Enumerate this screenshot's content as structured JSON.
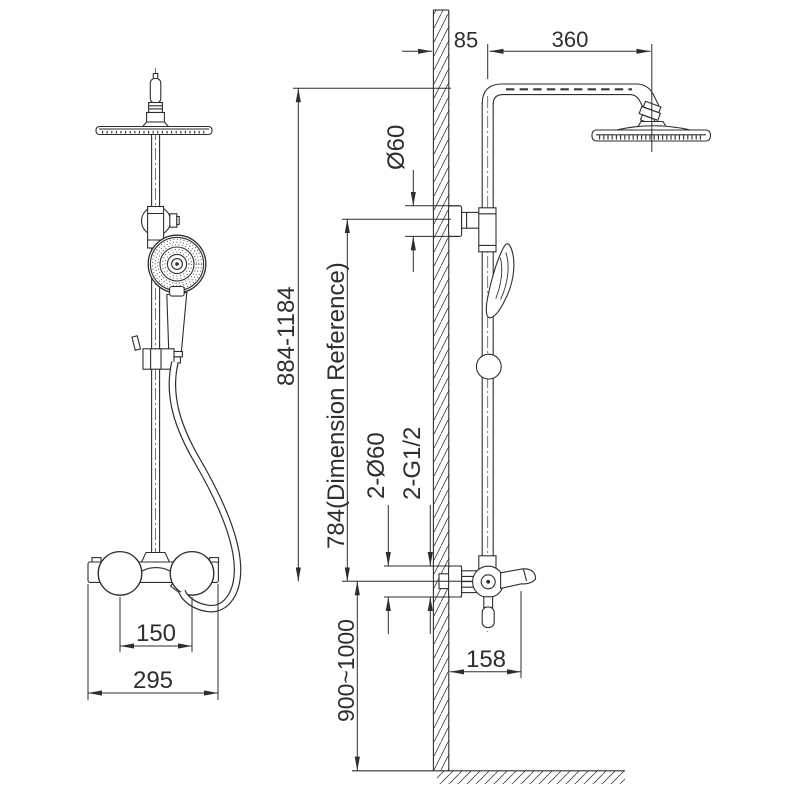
{
  "meta": {
    "background": "#ffffff",
    "ink": "#2e2e2e",
    "drawing_type": "technical dimension drawing",
    "subject": "thermostatic shower column system — front view and wall-mounted side view"
  },
  "dimensions": {
    "wall_offset": "85",
    "arm_reach": "360",
    "flange_diameter": "Ø60",
    "riser_height_range": "884-1184",
    "reference_height": "784(Dimension Reference)",
    "connections_diameter": "2-Ø60",
    "connections_thread": "2-G1/2",
    "mixer_height": "900~1000",
    "spout_reach": "158",
    "handle_spacing": "150",
    "mixer_width": "295"
  }
}
